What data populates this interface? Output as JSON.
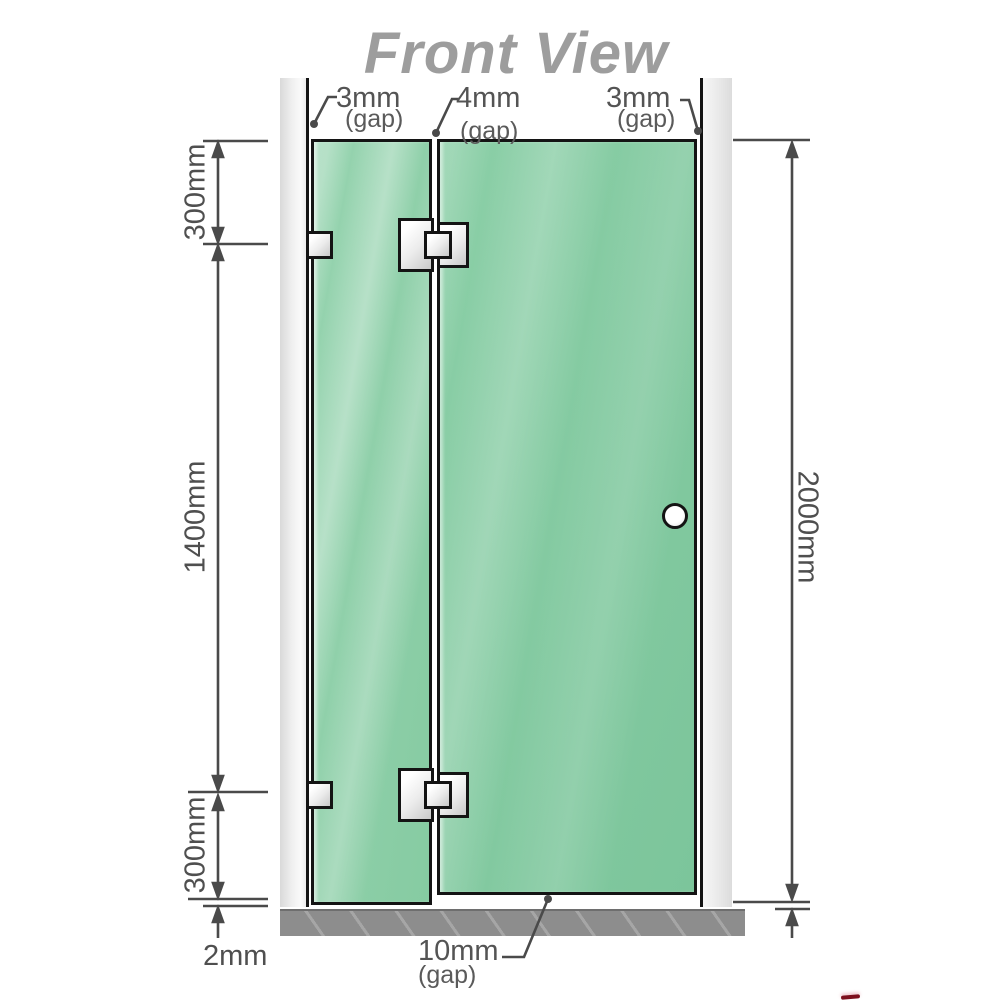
{
  "title": "Front View",
  "dimensions": {
    "left_top": "300mm",
    "left_middle": "1400mm",
    "left_bottom": "300mm",
    "bottom_left": "2mm",
    "right_height": "2000mm"
  },
  "gaps": {
    "wall_left": {
      "value": "3mm",
      "note": "(gap)"
    },
    "panel_middle": {
      "value": "4mm",
      "note": "(gap)"
    },
    "wall_right": {
      "value": "3mm",
      "note": "(gap)"
    },
    "floor": {
      "value": "10mm",
      "note": "(gap)"
    }
  },
  "colors": {
    "glass_green": "#8bcfa7",
    "dimension_line": "#4a4a4a",
    "label_text": "#4f4f4f",
    "title_text": "#9d9d9d",
    "wall_fill": "#e6e6e6",
    "floor_fill": "#8d8d8d",
    "hardware_fill": "#e9e9e9",
    "outline_black": "#141414",
    "accent_red": "#7d0f1d"
  }
}
